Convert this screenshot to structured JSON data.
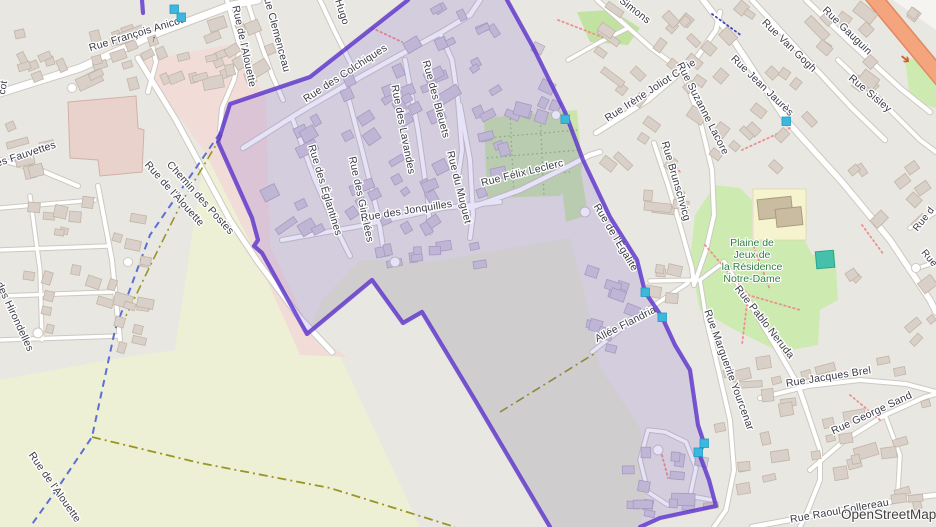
{
  "map": {
    "attribution": "OpenStreetMap",
    "colors": {
      "base": "#e9e7e1",
      "farmland": "#eef0d5",
      "farmland_inner": "#e4e7cf",
      "commercial_pink": "#f1dcd8",
      "park_green": "#cdebb0",
      "village_green": "#c2e2a2",
      "allotment_green": "#cbe5ab",
      "school_yellow": "#f6f3cf",
      "teal_building": "#44c0ab",
      "trunk_orange": "#f4a57e",
      "building_fill": "#d9d0c9",
      "building_tinted": "#d2cbd6",
      "road_fill": "#ffffff",
      "road_casing": "#ccc9c1",
      "boundary_purple": "#5a31cc",
      "boundary_tint": "rgba(88,60,200,0.15)",
      "node_cyan": "#3cb8dd",
      "track_blue": "#5b6fd5",
      "track_olive": "#9a9425",
      "footpath_red": "#ee8f8f",
      "label_color": "#3a3a46",
      "park_label_color": "#2f8040"
    },
    "street_labels": [
      {
        "text": "Rue François Anicot",
        "x": 137,
        "y": 37,
        "rot": -17
      },
      {
        "text": "cot",
        "x": 6,
        "y": 88,
        "rot": -80,
        "size": 10
      },
      {
        "text": "Rue de l'Alouette",
        "x": 241,
        "y": 47,
        "rot": 78
      },
      {
        "text": "Rue Clemenceau",
        "x": 273,
        "y": 32,
        "rot": 75
      },
      {
        "text": "Hugo",
        "x": 339,
        "y": 13,
        "rot": 72
      },
      {
        "text": "des Fauvettes",
        "x": 24,
        "y": 158,
        "rot": -18
      },
      {
        "text": "Chemin des Postes",
        "x": 198,
        "y": 200,
        "rot": 48
      },
      {
        "text": "des Hirondelles",
        "x": 12,
        "y": 318,
        "rot": 65
      },
      {
        "text": "Rue de l'Alouette",
        "x": 172,
        "y": 196,
        "rot": 48
      },
      {
        "text": "Rue de l'Alouette",
        "x": 52,
        "y": 489,
        "rot": 55
      },
      {
        "text": "Rue des Colchiques",
        "x": 347,
        "y": 76,
        "rot": -33
      },
      {
        "text": "Rue des Églantines",
        "x": 322,
        "y": 191,
        "rot": 73
      },
      {
        "text": "Rue des Giroflées",
        "x": 358,
        "y": 200,
        "rot": 78
      },
      {
        "text": "Rue des Lavandes",
        "x": 400,
        "y": 130,
        "rot": 79
      },
      {
        "text": "Rue des Bleuets",
        "x": 433,
        "y": 100,
        "rot": 75
      },
      {
        "text": "Rue du Muguet",
        "x": 456,
        "y": 188,
        "rot": 76
      },
      {
        "text": "Rue des Jonquilles",
        "x": 407,
        "y": 214,
        "rot": -9
      },
      {
        "text": "Rue Félix Leclerc",
        "x": 523,
        "y": 176,
        "rot": -14
      },
      {
        "text": "Rue de l'Égalité",
        "x": 613,
        "y": 239,
        "rot": 59
      },
      {
        "text": "Allée Flandria",
        "x": 627,
        "y": 327,
        "rot": -27
      },
      {
        "text": "Simons",
        "x": 633,
        "y": 13,
        "rot": 38
      },
      {
        "text": "Rue Irène Joliot Curie",
        "x": 652,
        "y": 93,
        "rot": -33
      },
      {
        "text": "Rue Suzanne Lacore",
        "x": 700,
        "y": 110,
        "rot": 63
      },
      {
        "text": "Rue Jean Jaurès",
        "x": 760,
        "y": 88,
        "rot": 44
      },
      {
        "text": "Rue Van Gogh",
        "x": 787,
        "y": 48,
        "rot": 44
      },
      {
        "text": "Rue Gauguin",
        "x": 845,
        "y": 33,
        "rot": 44
      },
      {
        "text": "Rue Sisley",
        "x": 868,
        "y": 96,
        "rot": 40
      },
      {
        "text": "Rue Brunschvicg",
        "x": 673,
        "y": 182,
        "rot": 74
      },
      {
        "text": "Rue Pablo Neruda",
        "x": 762,
        "y": 324,
        "rot": 52
      },
      {
        "text": "Rue Marguerite Yourcenar",
        "x": 726,
        "y": 371,
        "rot": 70
      },
      {
        "text": "Rue Jacques Brel",
        "x": 829,
        "y": 380,
        "rot": -9
      },
      {
        "text": "Rue George Sand",
        "x": 873,
        "y": 416,
        "rot": -25
      },
      {
        "text": "Rue Raoul Follereau",
        "x": 840,
        "y": 514,
        "rot": -10
      },
      {
        "text": "Rue d",
        "x": 926,
        "y": 221,
        "rot": -52,
        "size": 10
      },
      {
        "text": "Rue",
        "x": 927,
        "y": 260,
        "rot": 50,
        "size": 10
      }
    ],
    "park_label": {
      "x": 752,
      "y": 246,
      "line_height": 12,
      "lines": [
        "Plaine de",
        "Jeux de",
        "la Résidence",
        "Notre-Dame"
      ]
    },
    "arrows": [
      {
        "text": "➔",
        "x": 903,
        "y": 62,
        "rot": 38,
        "size": 12,
        "color": "#d2622d"
      },
      {
        "text": "↑",
        "x": 153,
        "y": 42,
        "rot": 14,
        "size": 10,
        "color": "#555555"
      }
    ],
    "nodes": [
      {
        "x": 174,
        "y": 9
      },
      {
        "x": 181,
        "y": 17
      },
      {
        "x": 565,
        "y": 119
      },
      {
        "x": 645,
        "y": 292
      },
      {
        "x": 662,
        "y": 317
      },
      {
        "x": 704,
        "y": 443
      },
      {
        "x": 698,
        "y": 452
      },
      {
        "x": 786,
        "y": 121
      }
    ]
  }
}
